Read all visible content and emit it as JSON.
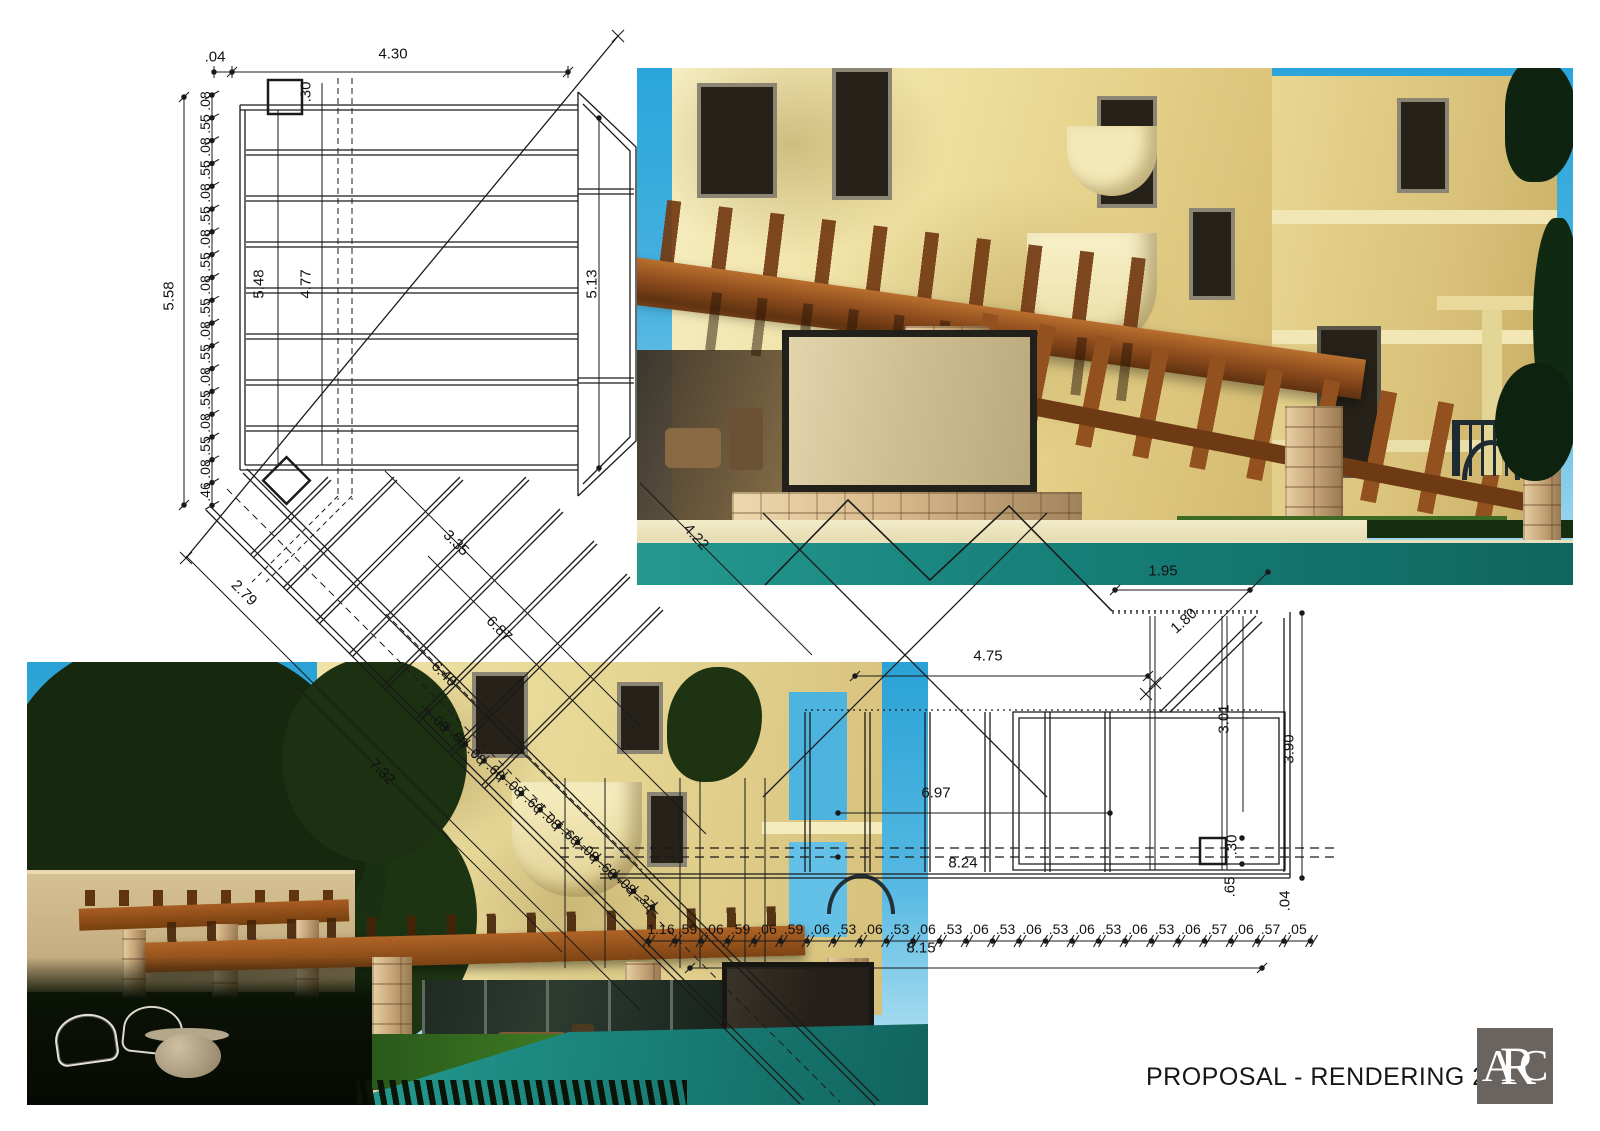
{
  "sheet": {
    "footer": {
      "title": "PROPOSAL - RENDERING 2019",
      "logo_text": "ARC",
      "year": "2019"
    },
    "colors": {
      "sky": "#2ba5db",
      "building_cream": "#efe0a0",
      "pergola_wood": "#8a4a1c",
      "stone": "#cbaa7d",
      "pool": "#1d8b82",
      "drawing_line": "#1a1a1a",
      "logo_background": "#6a6461",
      "lawn": "#3f7d24"
    }
  },
  "drawings": {
    "plan": {
      "name": "pergola-plan",
      "dim_overall_height": "5.58",
      "dim_top_offset": ".04",
      "dim_top_width": "4.30",
      "dim_col_30": ".30",
      "dim_inner_548": "5.48",
      "dim_inner_477": "4.77",
      "dim_right_513": "5.13",
      "left_chain": [
        ".08",
        ".55",
        ".08",
        ".55",
        ".08",
        ".55",
        ".08",
        ".55",
        ".08",
        ".55",
        ".08",
        ".55",
        ".08",
        ".55",
        ".08",
        ".55",
        ".08",
        ".46"
      ],
      "diag_dims": {
        "d335": "3.35",
        "d279": "2.79",
        "d687": "6.87",
        "d640": "6.40",
        "d732": "7.32",
        "d422": "4.22"
      },
      "diag_chain": [
        ".08",
        ".60",
        ".08",
        ".60",
        ".08",
        ".60",
        ".08",
        ".60",
        ".08",
        ".60",
        ".08",
        ".37"
      ]
    },
    "plan_right": {
      "name": "pergola-plan-bottom-right",
      "dims": {
        "d475": "4.75",
        "d195": "1.95",
        "d180": "1.80",
        "d301": "3.01",
        "d390": "3.90",
        "d697": "6.97",
        "d824": "8.24",
        "d815": "8.15",
        "d30": ".30",
        "d65": ".65",
        "d04": ".04"
      },
      "bottom_chain": [
        "1.16",
        ".59",
        ".06",
        ".59",
        ".06",
        ".59",
        ".06",
        ".53",
        ".06",
        ".53",
        ".06",
        ".53",
        ".06",
        ".53",
        ".06",
        ".53",
        ".06",
        ".53",
        ".06",
        ".53",
        ".06",
        ".57",
        ".06",
        ".57",
        ".05"
      ]
    }
  },
  "renders": {
    "top_right": {
      "name": "exterior-render-day-pergola-view"
    },
    "bottom_left": {
      "name": "exterior-render-evening-pool-view"
    }
  }
}
